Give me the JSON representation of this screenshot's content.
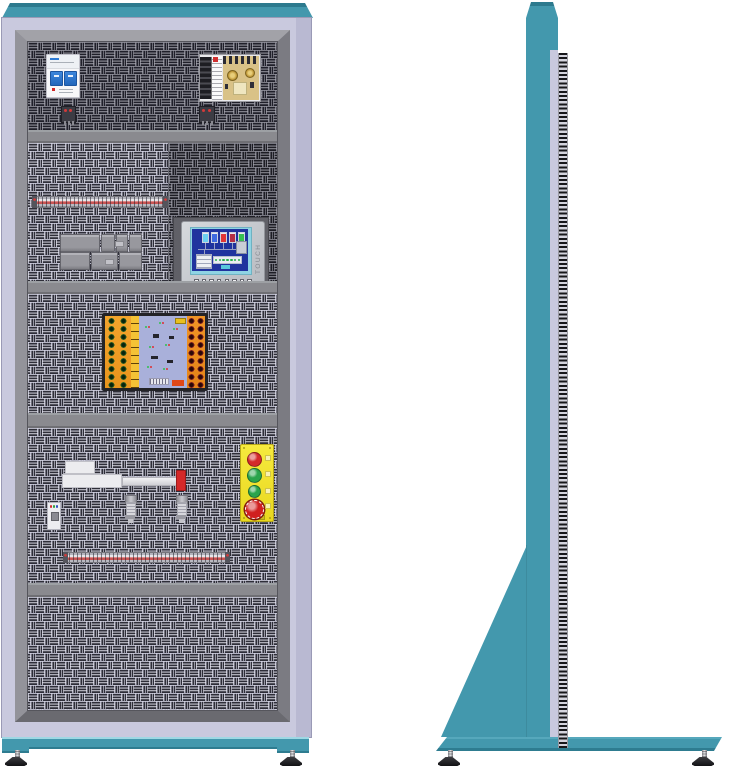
{
  "colors": {
    "teal": "#4398ad",
    "teal_dark": "#2d7a8e",
    "teal_light": "#9ed8e4",
    "lavender": "#c9c9de",
    "lavender_shade": "#b9b9d2",
    "frame_gray": "#8b8b90",
    "panel_light_bg": "#d6d6e6",
    "panel_dark_bg": "#9595a0",
    "subpanel_bg": "#8e8e9a",
    "screen_blue": "#20339e",
    "screen_border_cyan": "#8fd4e4",
    "station_yellow": "#f3e32b",
    "plc_orange": "#f09c28",
    "plc_center": "#a9b0da",
    "terminal_strip_red": "#c85454",
    "rod_cap_red": "#d42828"
  },
  "front_view": {
    "panels": [
      {
        "name": "panel-1",
        "components": [
          "circuit-breaker",
          "switching-power-supply",
          "terminal-block",
          "terminal-block"
        ]
      },
      {
        "name": "panel-2",
        "components": [
          "terminal-strip",
          "relay-module-group",
          "hmi-touch-panel",
          "terminal-strip"
        ]
      },
      {
        "name": "panel-3",
        "components": [
          "plc-training-board"
        ]
      },
      {
        "name": "panel-4",
        "components": [
          "linear-actuator",
          "photo-sensor",
          "proximity-sensor",
          "proximity-sensor",
          "push-button-station",
          "terminal-strip"
        ]
      },
      {
        "name": "panel-5",
        "components": []
      }
    ],
    "hmi": {
      "side_label": "TOUCH",
      "tank_colors": [
        "#6ccff0",
        "#3f6ae0",
        "#e13636",
        "#b43046",
        "#37c050"
      ],
      "function_key_count": 8,
      "indicator_dot_count": 7
    },
    "relay_group": {
      "top_row_modules": 4,
      "bottom_row_modules": 3
    },
    "plc_board": {
      "socket_rows": 9,
      "left_socket_columns": 2,
      "right_socket_columns": 2
    },
    "push_station": {
      "buttons": [
        {
          "name": "red-push-button",
          "color": "#d42a2a",
          "style": "round"
        },
        {
          "name": "green-push-button",
          "color": "#2aa44c",
          "style": "round"
        },
        {
          "name": "green-push-button-small",
          "color": "#2aa44c",
          "style": "round-small"
        },
        {
          "name": "emergency-stop-button",
          "color": "#d02020",
          "style": "mushroom"
        }
      ]
    },
    "feet_count": 2
  },
  "side_view": {
    "feet_count": 2
  }
}
